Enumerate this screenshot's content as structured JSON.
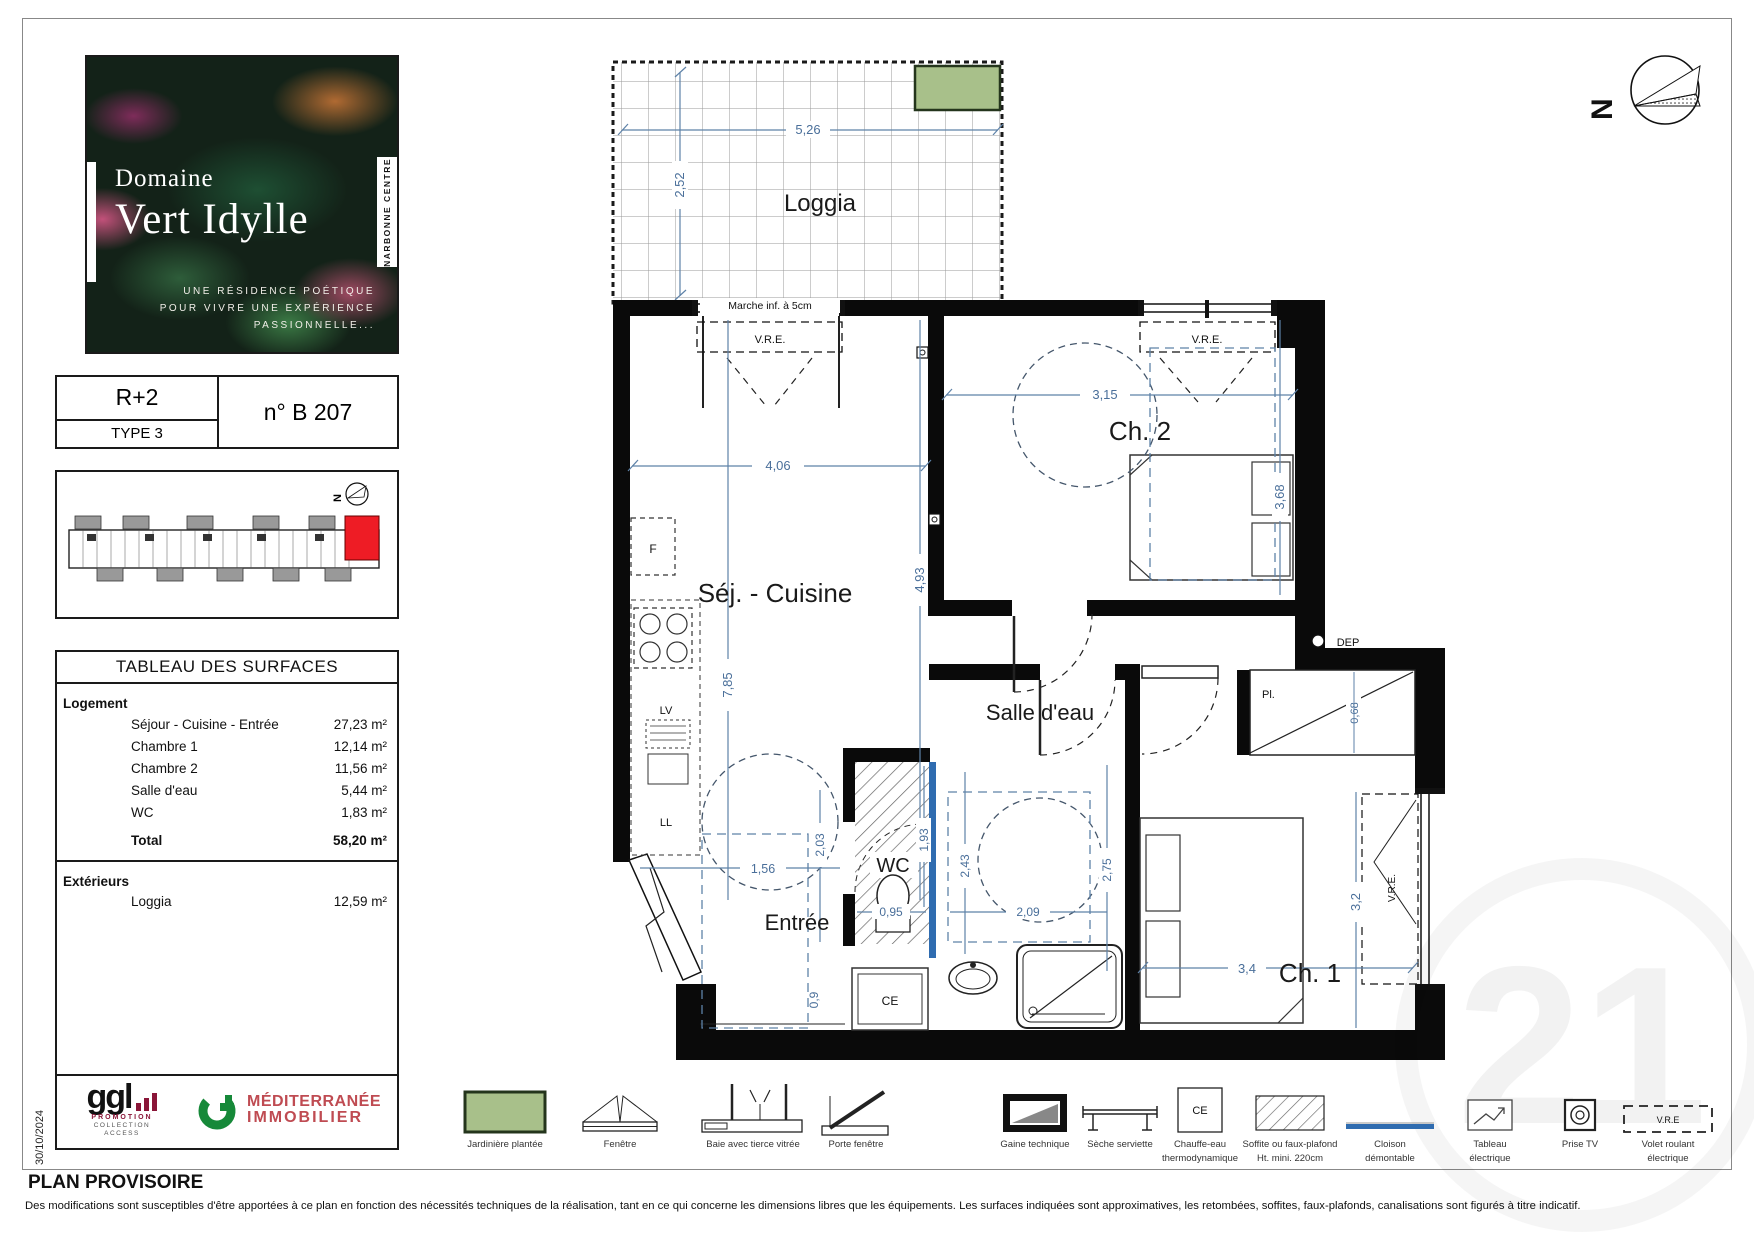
{
  "page": {
    "date": "30/10/2024",
    "status": "PLAN PROVISOIRE",
    "disclaimer": "Des modifications sont susceptibles d'être apportées à ce plan en fonction des nécessités techniques de la réalisation, tant en ce qui concerne les dimensions libres que les équipements. Les surfaces indiquées sont approximatives, les retombées, soffites, faux-plafonds, canalisations sont figurés à titre indicatif.",
    "watermark": "21"
  },
  "brand": {
    "name_line1": "Domaine",
    "name_line2": "Vert Idylle",
    "location": "NARBONNE CENTRE",
    "tagline_line1": "UNE RÉSIDENCE POÉTIQUE",
    "tagline_line2": "POUR VIVRE UNE EXPÉRIENCE",
    "tagline_line3": "PASSIONNELLE..."
  },
  "unit": {
    "floor": "R+2",
    "type": "TYPE 3",
    "number": "n° B 207"
  },
  "surfaces": {
    "title": "TABLEAU DES SURFACES",
    "group_logement": "Logement",
    "rows": [
      {
        "label": "Séjour - Cuisine - Entrée",
        "value": "27,23 m²"
      },
      {
        "label": "Chambre 1",
        "value": "12,14 m²"
      },
      {
        "label": "Chambre 2",
        "value": "11,56 m²"
      },
      {
        "label": "Salle d'eau",
        "value": "5,44 m²"
      },
      {
        "label": "WC",
        "value": "1,83 m²"
      }
    ],
    "total_label": "Total",
    "total_value": "58,20 m²",
    "group_exterieurs": "Extérieurs",
    "ext_rows": [
      {
        "label": "Loggia",
        "value": "12,59 m²"
      }
    ]
  },
  "plan": {
    "rooms": {
      "loggia": "Loggia",
      "sejour": "Séj. - Cuisine",
      "ch2": "Ch. 2",
      "ch1": "Ch. 1",
      "sde": "Salle d'eau",
      "wc": "WC",
      "entree": "Entrée"
    },
    "labels": {
      "marche": "Marche inf. à 5cm",
      "vre": "V.R.E.",
      "dep": "DEP",
      "pl": "Pl.",
      "f": "F",
      "lv": "LV",
      "ll": "LL",
      "ce": "CE"
    },
    "dims": {
      "d526": "5,26",
      "d252": "2,52",
      "d406": "4,06",
      "d493": "4,93",
      "d785": "7,85",
      "d315": "3,15",
      "d368": "3,68",
      "d156": "1,56",
      "d203": "2,03",
      "d193": "1,93",
      "d095": "0,95",
      "d243": "2,43",
      "d209": "2,09",
      "d275": "2,75",
      "d068": "0,68",
      "d32": "3,2",
      "d34": "3,4",
      "d09": "0,9"
    }
  },
  "legend": {
    "items": [
      {
        "label": "Jardinière plantée"
      },
      {
        "label": "Fenêtre"
      },
      {
        "label": "Baie avec tierce vitrée"
      },
      {
        "label": "Porte fenêtre"
      },
      {
        "label": "Gaine technique"
      },
      {
        "label": "Sèche serviette"
      },
      {
        "label": "Chauffe-eau",
        "label2": "thermodynamique"
      },
      {
        "label": "Soffite ou faux-plafond",
        "label2": "Ht. mini. 220cm"
      },
      {
        "label": "Cloison",
        "label2": "démontable"
      },
      {
        "label": "Tableau",
        "label2": "électrique"
      },
      {
        "label": "Prise TV"
      },
      {
        "label": "Volet roulant",
        "label2": "électrique"
      }
    ],
    "vre_short": "V.R.E"
  },
  "logos": {
    "ggl": "ggl",
    "ggl_sub1": "PROMOTION",
    "ggl_sub2": "COLLECTION",
    "ggl_sub3": "ACCESS",
    "med_line1": "MÉDITERRANÉE",
    "med_line2": "IMMOBILIER"
  },
  "compass": {
    "north": "N"
  }
}
